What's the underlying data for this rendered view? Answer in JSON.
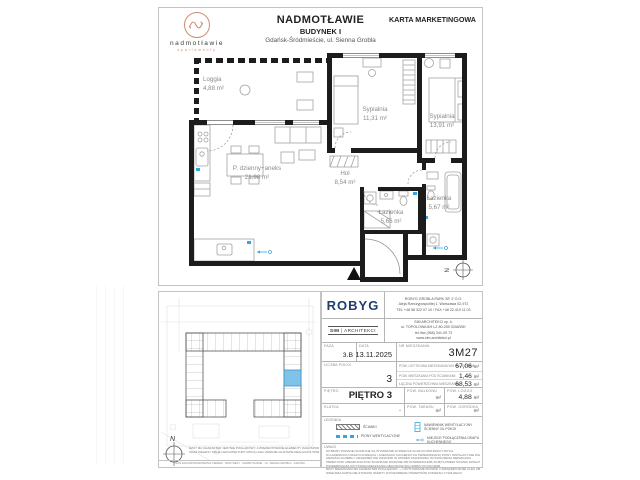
{
  "header": {
    "brand": "nadmotławie",
    "brand_sub": "apartamenty",
    "title": "NADMOTŁAWIE",
    "subtitle": "BUDYNEK I",
    "address": "Gdańsk-Śródmieście, ul. Sienna Grobla",
    "doc_type": "KARTA MARKETINGOWA"
  },
  "colors": {
    "accent": "#cf8b72",
    "blue": "#2fa8dd",
    "navy": "#1e3f6e"
  },
  "floor_plan": {
    "compass": "N",
    "rooms": [
      {
        "name": "Loggia",
        "area": "4,88 m²"
      },
      {
        "name": "Sypialnia",
        "area": "11,31 m²"
      },
      {
        "name": "Sypialnia",
        "area": "13,91 m²"
      },
      {
        "name": "P. dzienny+aneks",
        "area": "21,98 m²"
      },
      {
        "name": "Hol",
        "area": "8,54 m²"
      },
      {
        "name": "Łazienka",
        "area": "5,66 m²"
      },
      {
        "name": "Łazienka",
        "area": "5,67 m²"
      }
    ]
  },
  "site_plan": {
    "compass": "N",
    "note1": "RZUT MA CHARAKTER JEDYNIE POGLĄDOWY, A PREZENTOWANE ELEMENTY ZAGOSPODAROWANIA TERENU",
    "note2": "ORAZ ZIELENI I MAŁEJ ARCHITEKTURY MOGĄ ULEC ZMIANIE NA ETAPIE REALIZACJI INWESTYCJI",
    "footer": "PLAN ZAGOSPODAROWANIA TERENU · BUDYNEK I · NADMOTŁAWIE · UL. SIENNA GROBLA · GDAŃSK"
  },
  "developer": {
    "name": "ROBYG",
    "line1": "ROBYG GROBLA PARK SP. Z O.O.",
    "line2": "Aleja Rzeczypospolitej 1, Warszawa 02-972",
    "line3": "TEL +48 58 322 07 10 / FAX +48 22 419 11 03"
  },
  "architect": {
    "name_a": "SIM",
    "name_b": "ARCHITEKCI",
    "line1": "SIM ARCHITEKCI sp. k.",
    "line2": "ul. TOPOLOWA 8/9 LZ 80-255 GDAŃSK",
    "line3": "tel./fax (058) 341-09 73",
    "line4": "www.sim-architekci.pl"
  },
  "table": {
    "unit": "m²",
    "faza_label": "FAZA",
    "faza": "3.B",
    "data_label": "DATA",
    "data": "13.11.2025",
    "nr_label": "NR MIESZKANIA",
    "nr": "3M27",
    "liczba_pokoi_label": "LICZBA POKOI",
    "liczba_pokoi": "3",
    "pow_uzytkowa_label": "POW. UŻYTKOWA MIESZKANIA WG PN-ISO 9836",
    "pow_uzytkowa": "67,06",
    "pow_scianki_label": "POW. MIESZKANIA POD ŚCIANKAMI",
    "pow_scianki": "1,46",
    "pow_laczna_label": "ŁĄCZNA POWIERZCHNIA MIESZKANIA",
    "pow_laczna": "68,53",
    "pietro_label": "PIĘTRO",
    "pietro": "PIĘTRO 3",
    "balkon_label": "POW. BALKONU",
    "balkon": "",
    "loggia_label": "POW. LOGGII",
    "loggia": "4,88",
    "klatka_label": "KLATKA",
    "klatka": "-",
    "taras_label": "POW. TARASU",
    "taras": "",
    "ogrodek_label": "POW. OGRÓDKA",
    "ogrodek": ""
  },
  "legend": {
    "title": "LEGENDA",
    "item1": "ŚCIANKI",
    "item2": "PIONY WENTYLACYJNE",
    "item3a": "NAWIEWNIK WENTYLACYJNY ŚCIENNY",
    "item3b": "GŁ.POKOI",
    "item4": "MIEJSCE PODŁĄCZENIA OKAPU KUCHENNEGO"
  },
  "uwagi": {
    "title": "UWAGI",
    "lines": [
      "WYMIARY PODANE NA RZUCIE SĄ WYMIARAMI W ŚWIETLE ŚCIAN KONSTRUKCYJNYCH",
      "W ŁAZIENKACH ORAZ KUCHNIACH / ANEKSACH KUCHENNYCH PRZEWIDZIANO PIONY INSTALACYJNE WG PROJEKTU WYKONAWCZEGO",
      "ARANŻACJA MEBLI I URZĄDZEŃ NIE WCHODZI W ZAKRES STANDARDU WYKOŃCZENIA MIESZKANIA",
      "PRZEZ POW. MIESZKANIA POD ŚCIANKAMI ROZUMIE SIĘ POWIERZCHNIĘ ZAJĘTĄ PRZEZ ŚCIANKI DZIAŁOWE",
      "POWIERZCHNIA UŻYTKOWA MIESZKANIA OBLICZONA WG NORMY PN-ISO 9836",
      "RZUT MIESZKANIA MA CHARAKTER POGLĄDOWY — USYTUOWANIE PIONÓW I URZĄDZEŃ MOŻE ULEC ZMIANIE",
      "NINIEJSZA KARTA NIE STANOWI OFERTY W ROZUMIENIU PRZEPISÓW KODEKSU CYWILNEGO"
    ]
  }
}
